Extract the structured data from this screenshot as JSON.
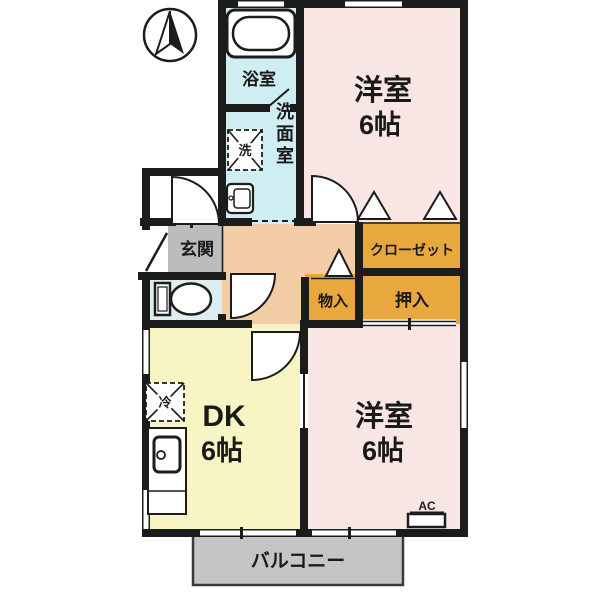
{
  "labels": {
    "bathroom": "浴室",
    "washer_symbol": "洗",
    "washroom": "洗面室",
    "bedroom_top_name": "洋室",
    "bedroom_top_size": "6帖",
    "entrance": "玄関",
    "closet": "クローゼット",
    "storage": "物入",
    "oshiire": "押入",
    "dk_name": "DK",
    "dk_size": "6帖",
    "fridge_symbol": "冷",
    "bedroom_bottom_name": "洋室",
    "bedroom_bottom_size": "6帖",
    "ac": "AC",
    "balcony": "バルコニー"
  },
  "colors": {
    "wall": "#1c1c1c",
    "wet_room": "#cfeef2",
    "toilet_room": "#ddeef0",
    "bedroom": "#f8e6e4",
    "hall": "#f2cda6",
    "entrance": "#bcbcbc",
    "closet": "#e9a83e",
    "dk": "#f7f5c4",
    "balcony": "#c5c5c5"
  }
}
